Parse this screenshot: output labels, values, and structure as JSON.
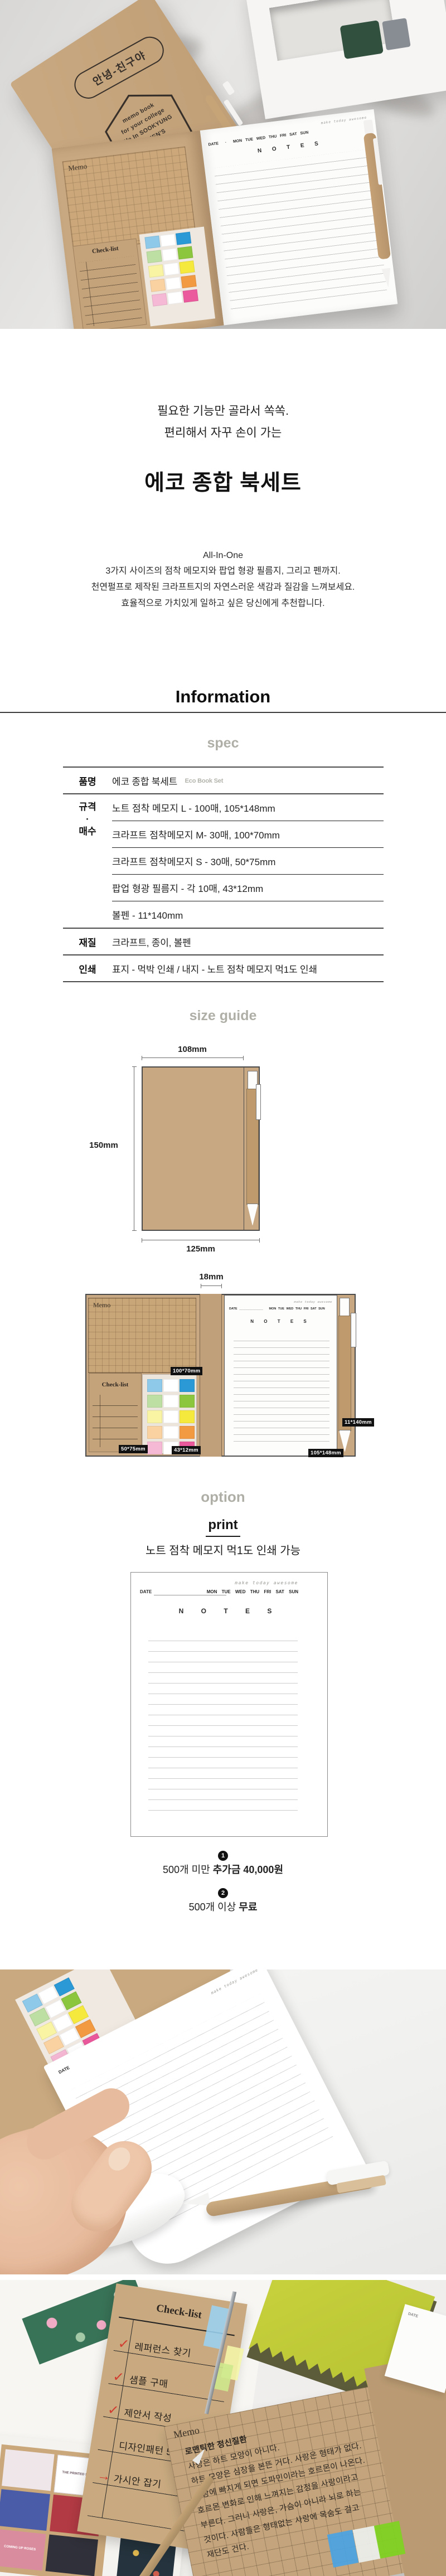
{
  "page_title": "에코 종합 북세트 상품 상세",
  "colors": {
    "kraft": "#c6a57e",
    "heading_gray": "#afafa7",
    "rule_dark": "#4b4b4b",
    "label_bg": "#111111",
    "check_red": "#d23b2f",
    "flags": [
      {
        "light": "#8ec9e9",
        "dark": "#2b99d6"
      },
      {
        "light": "#bedfa3",
        "dark": "#8cc63f"
      },
      {
        "light": "#f9f4a4",
        "dark": "#f6e93e"
      },
      {
        "light": "#fad2a2",
        "dark": "#f29a42"
      },
      {
        "light": "#f6b9d5",
        "dark": "#eb5a9d"
      }
    ]
  },
  "labels": {
    "memo": "Memo",
    "checklist": "Check-list"
  },
  "notepad": {
    "motto": "make today awesome",
    "date_label": "DATE",
    "weekdays": "MON TUE WED THU FRI SAT SUN",
    "notes_title": "N O T E S"
  },
  "hero": {
    "stamp_pill": "안녕-친구야",
    "stamp_hex_lines": [
      "memo book",
      "for your college",
      "life In SOOKYUNG",
      "WOMEN'S",
      "UNIVERSITY"
    ]
  },
  "intro": {
    "tagline1": "필요한 기능만 골라서 쏙쏙.",
    "tagline2": "편리해서 자꾸 손이 가는",
    "title": "에코 종합 북세트",
    "subtitle": "All-In-One",
    "desc1": "3가지 사이즈의 점착 메모지와 팝업 형광 필름지, 그리고 펜까지.",
    "desc2": "천연펄프로 제작된 크라프트지의 자연스러운 색감과 질감을 느껴보세요.",
    "desc3": "효율적으로 가치있게 일하고 싶은 당신에게 추천합니다."
  },
  "information": {
    "heading": "Information",
    "spec_heading": "spec",
    "table": {
      "rows": [
        {
          "label": "품명",
          "value": "에코 종합 북세트",
          "value_en": "Eco Book Set"
        },
        {
          "label_lines": [
            "규격",
            "·",
            "매수"
          ],
          "values": [
            "노트 점착 메모지 L - 100매, 105*148mm",
            "크라프트 점착메모지 M- 30매, 100*70mm",
            "크라프트 점착메모지 S - 30매, 50*75mm",
            "팝업 형광 필름지 - 각 10매, 43*12mm",
            "볼펜 - 11*140mm"
          ]
        },
        {
          "label": "재질",
          "value": "크라프트, 종이, 볼펜"
        },
        {
          "label": "인쇄",
          "value": "표지 - 먹박 인쇄 / 내지 - 노트 점착 메모지 먹1도 인쇄"
        }
      ]
    }
  },
  "size_guide": {
    "heading": "size guide",
    "closed": {
      "width": "108mm",
      "height": "150mm",
      "total_width": "125mm"
    },
    "open": {
      "spine": "18mm",
      "memo_size": "100*70mm",
      "checklist_size": "50*75mm",
      "flags_size": "43*12mm",
      "notes_size": "105*148mm",
      "pen_size": "11*140mm"
    }
  },
  "option": {
    "heading": "option",
    "sub_heading": "print",
    "caption": "노트 점착 메모지 먹1도 인쇄 가능",
    "notes": [
      {
        "num": "1",
        "text": "500개 미만 ",
        "bold": "추가금 40,000원"
      },
      {
        "num": "2",
        "text": "500개 이상 ",
        "bold": "무료"
      }
    ]
  },
  "photo3": {
    "checklist_items": [
      {
        "mark": "✓",
        "text": "레퍼런스 찾기"
      },
      {
        "mark": "✓",
        "text": "샘플 구매"
      },
      {
        "mark": "✓",
        "text": "제안서 작성"
      },
      {
        "mark": "",
        "text": "디자인패턴 5가지"
      },
      {
        "mark": "→",
        "text": "가시안 잡기"
      }
    ],
    "memo_lines": [
      "로맨틱한 정신질환",
      "사랑은 하트 모양이 아니다.",
      "하트 모양은 심장을 본뜬 거다. 사랑은 형태가 없다.",
      "사랑에 빠지게 되면 도파민이라는 호르몬이 나온다.",
      "호르몬 변화로 인해 느껴지는 감정을 사랑이라고",
      "부른다. 그러니 사랑은, 가슴이 아니라 뇌로 하는",
      "것이다. 사람들은 형태없는 사랑에 목숨도 걸고",
      "재단도 건다."
    ],
    "magazine": {
      "cover1": "THE PRINTED SQUARE",
      "cover2": "COMING UP ROSES"
    }
  }
}
